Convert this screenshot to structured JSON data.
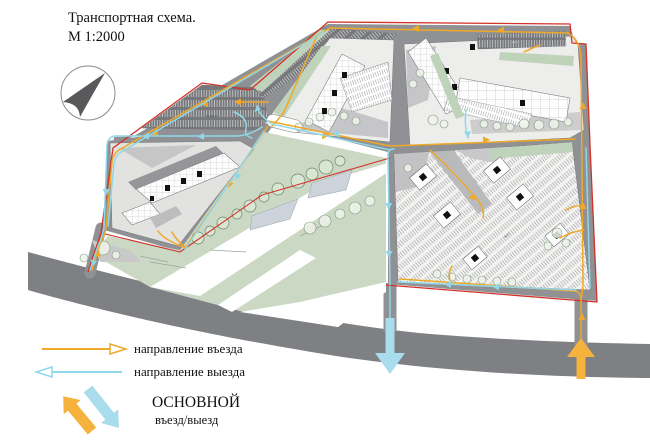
{
  "title": {
    "line1": "Транспортная схема.",
    "line2": "М 1:2000"
  },
  "legend": {
    "entry": {
      "label": "направление въезда"
    },
    "exit": {
      "label": "направление выезда"
    },
    "main": {
      "line1": "ОСНОВНОЙ",
      "line2": "въезд/выезд"
    }
  },
  "plan": {
    "parking_labels": [
      "61 место",
      "мест",
      "мест"
    ],
    "compass": "north-arrow"
  },
  "colors": {
    "entry": "#efa829",
    "exit": "#8fd7e9",
    "boundary": "#d23228",
    "road": "#8f9194",
    "main-road": "#7e8083",
    "green": "#cbd8c4",
    "green-strip": "#bfd2ba",
    "parking-dark": "#76787b",
    "block-light": "#ededeb",
    "building": "#fdfdfd",
    "pond": "#ccd3da",
    "big-entry": "#f5b33e",
    "big-exit": "#a9dcec"
  }
}
